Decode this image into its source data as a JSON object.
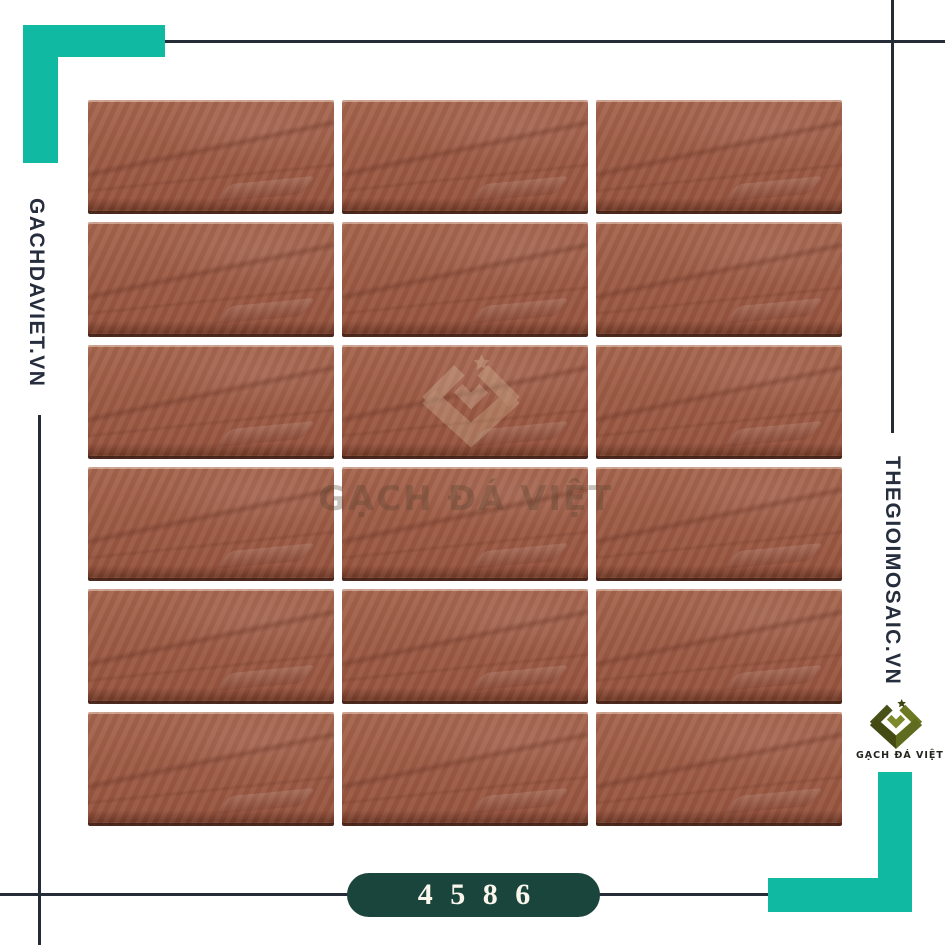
{
  "canvas": {
    "width": 945,
    "height": 945,
    "background": "#ffffff"
  },
  "branding": {
    "left_site_text": "GACHDAVIET.VN",
    "right_site_text": "THEGIOIMOSAIC.VN",
    "logo_label": "GẠCH ĐÁ VIỆT",
    "logo_icon": "diamond-chevron-star-icon",
    "watermark_text": "GẠCH ĐÁ VIỆT"
  },
  "product": {
    "code_badge": "4 5 8 6",
    "tile_grid": {
      "rows": 6,
      "columns": 3,
      "tile_count": 18
    }
  },
  "colors": {
    "accent_teal": "#0fb9a2",
    "rule_line": "#262b38",
    "site_text": "#262d3c",
    "badge_background": "#1a453d",
    "badge_text": "#faf6ec",
    "tile_base": "#9c5b45",
    "tile_edge_shadow": "#341a11",
    "logo_olive_dark": "#49511a",
    "logo_olive_light": "#6d7822"
  }
}
